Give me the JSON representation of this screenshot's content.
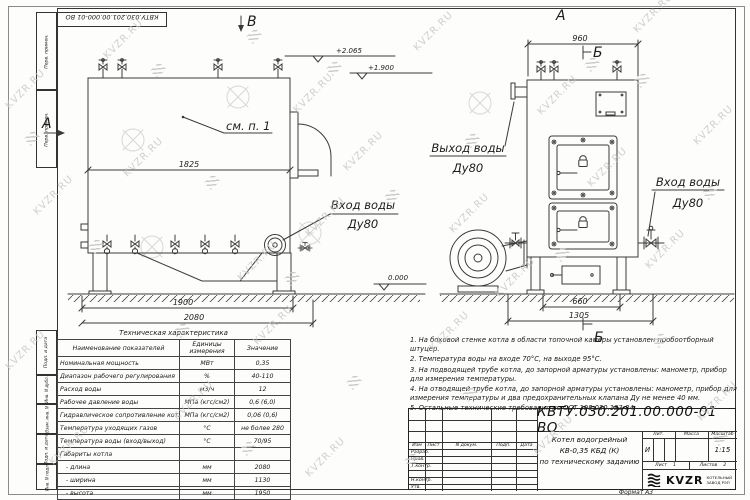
{
  "watermark": {
    "text": "KVZR.RU"
  },
  "sheet": {
    "stamp_top": "КВТУ.030.201.00.000-01 ВО",
    "format_note": "Формат  А3",
    "sidebar_top": [
      "Перв. примен.",
      "Перв. примен."
    ],
    "sidebar_bottom": [
      "Подп. и дата",
      "Инв. N дубл.",
      "Взам. инв. N",
      "Подп. и дата",
      "Инв. N подл."
    ]
  },
  "left_view": {
    "marker_v": "В",
    "marker_a": "А",
    "see_note": "см. п. 1",
    "dim_inner": "1825",
    "dim_base": "1900",
    "dim_total": "2080",
    "elev_top": "+2.065",
    "elev_mid": "+1.900",
    "elev_zero": "0.000",
    "inlet_line1": "Вход воды",
    "inlet_line2": "Ду80"
  },
  "right_view": {
    "marker_a": "А",
    "marker_b_top": "Б",
    "marker_b_bottom": "Б",
    "dim_width": "960",
    "dim_base": "660",
    "dim_total": "1305",
    "outlet_line1": "Выход воды",
    "outlet_line2": "Ду80",
    "inlet_line1": "Вход воды",
    "inlet_line2": "Ду80"
  },
  "tech_table": {
    "title": "Техническая характеристика",
    "headers": [
      "Наименование показателей",
      "Единицы измерения",
      "Значение"
    ],
    "rows": [
      [
        "Номинальная мощность",
        "МВт",
        "0,35"
      ],
      [
        "Диапазон рабочего регулирования",
        "%",
        "40-110"
      ],
      [
        "Расход воды",
        "м3/ч",
        "12"
      ],
      [
        "Рабочее давление воды",
        "МПа (кгс/см2)",
        "0,6 (6,0)"
      ],
      [
        "Гидравлическое сопротивление котла",
        "МПа (кгс/см2)",
        "0,06 (0,6)"
      ],
      [
        "Температура уходящих газов",
        "°С",
        "не более 280"
      ],
      [
        "Температура воды (вход/выход)",
        "°С",
        "70/95"
      ],
      [
        "Габариты котла",
        "",
        ""
      ],
      [
        "   - длина",
        "мм",
        "2080"
      ],
      [
        "   - ширина",
        "мм",
        "1130"
      ],
      [
        "   - высота",
        "мм",
        "1950"
      ]
    ]
  },
  "notes": [
    "1. На боковой стенке котла в области топочной камеры установлен пробоотборный штуцер.",
    "2. Температура воды на входе 70°С, на выходе 95°С.",
    "3. На подводящей трубе котла, до запорной арматуры установлены: манометр, прибор для измерения температуры.",
    "4. На отводящей трубе котла, до запорной арматуры установлены: манометр, прибор для измерения температуры и два предохранительных клапана Ду не менее 40 мм.",
    "5. Остальные технические требования по ОСТ 108.030.133-84."
  ],
  "title_block": {
    "doc_number": "КВТУ.030.201.00.000-01 ВО",
    "rev_headers": [
      "Изм",
      "Лист",
      "N докум.",
      "Подп.",
      "Дата"
    ],
    "roles": [
      "Разраб.",
      "Пров.",
      "Т.контр.",
      "Н.контр.",
      "Утв."
    ],
    "product_line1": "Котел водогрейный",
    "product_line2": "КВ-0,35 КБД (К)",
    "product_line3": "по техническому заданию",
    "lit_header": "Лит.",
    "mass_header": "Масса",
    "scale_header": "Масштаб",
    "lit_value": "И",
    "scale_value": "1:15",
    "sheet_label": "Лист",
    "sheet_value": "1",
    "sheets_label": "Листов",
    "sheets_value": "2",
    "logo_text": "KVZR",
    "logo_sub1": "КОТЕЛЬНЫЙ",
    "logo_sub2": "ЗАВОД РЭП"
  }
}
